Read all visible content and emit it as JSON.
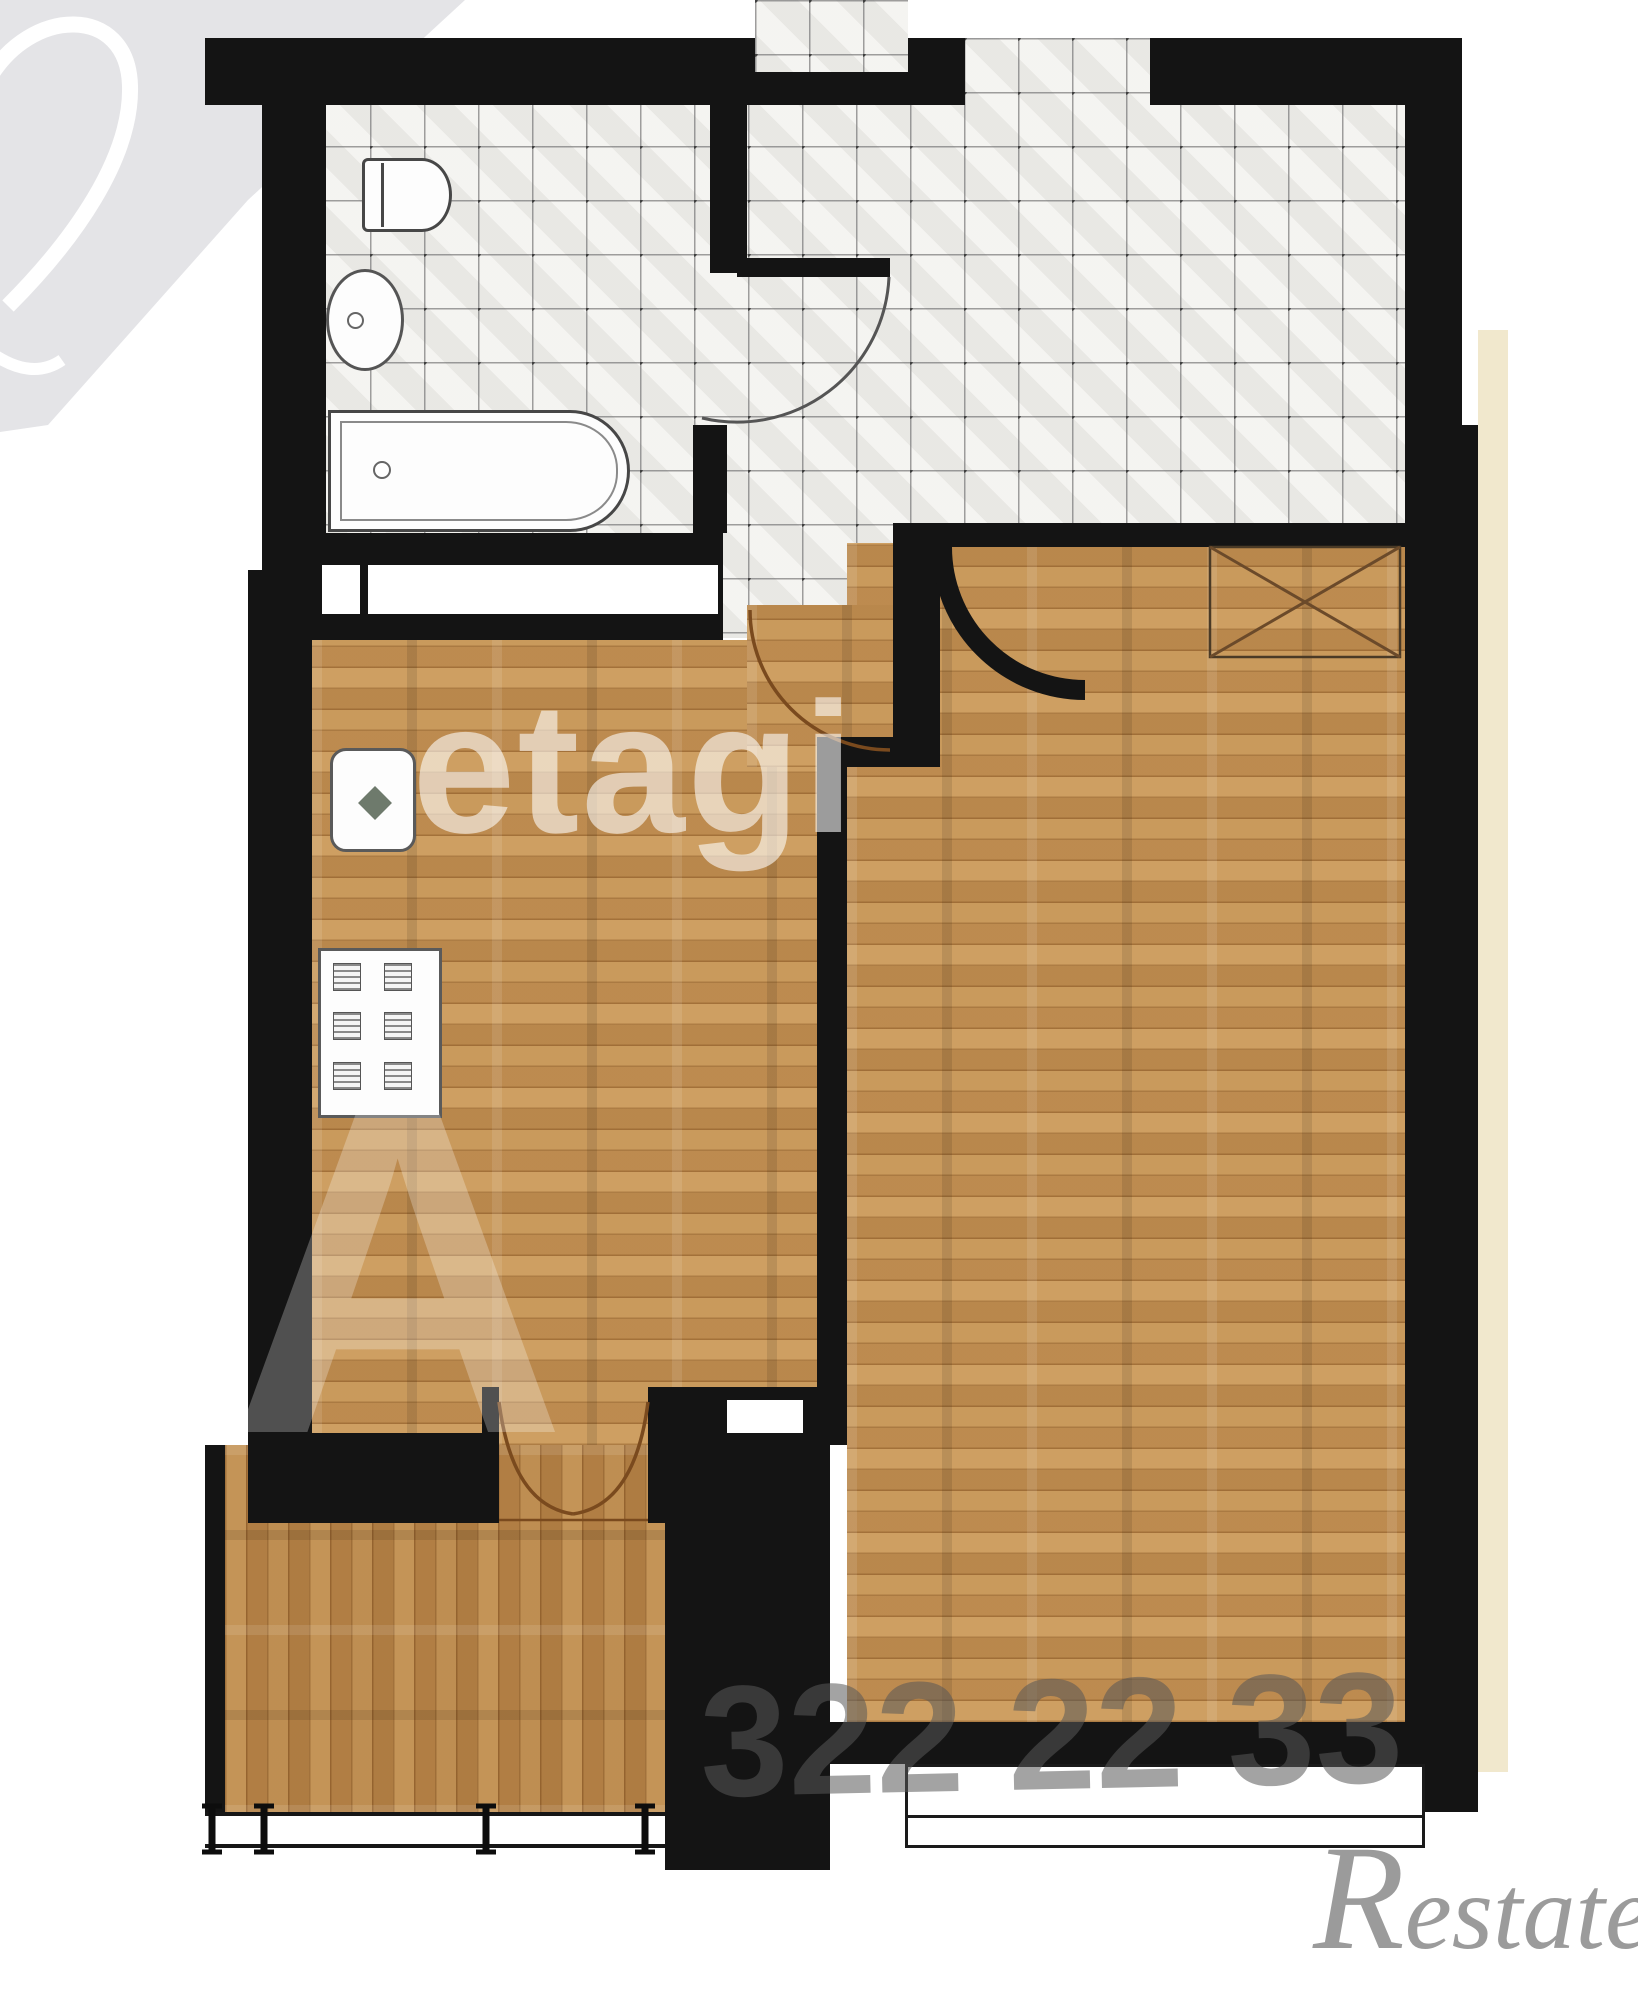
{
  "document": {
    "kind": "apartment floor plan (1-room flat), top-down architectural render",
    "rooms": [
      "bathroom",
      "entrance-hall",
      "kitchen",
      "living-room",
      "balcony"
    ]
  },
  "watermarks": {
    "top_left_numeral": "2",
    "center_text": "etagi",
    "corner_letter": "A",
    "phone_digits": "322 22 33",
    "agency_cap": "R",
    "agency_rest": "estate",
    "agency_full": "Restate"
  },
  "fixtures": [
    "toilet",
    "wash-basin",
    "bathtub",
    "kitchen-sink",
    "stove",
    "wardrobe-crossed-box",
    "balcony-double-door",
    "window",
    "balcony-glazing"
  ],
  "colors": {
    "wall": "#141414",
    "tile_floor": "#f2f1ee",
    "tile_grid": "#6e6e6e",
    "wood_floor": "#c89859",
    "balcony_wood": "#bd8c4e",
    "door_arc": "#7a4a1e",
    "outside_strip": "#f1e8cd",
    "logo_gray": "#e4e4e7",
    "restate_gray": "#9b9b9b"
  }
}
